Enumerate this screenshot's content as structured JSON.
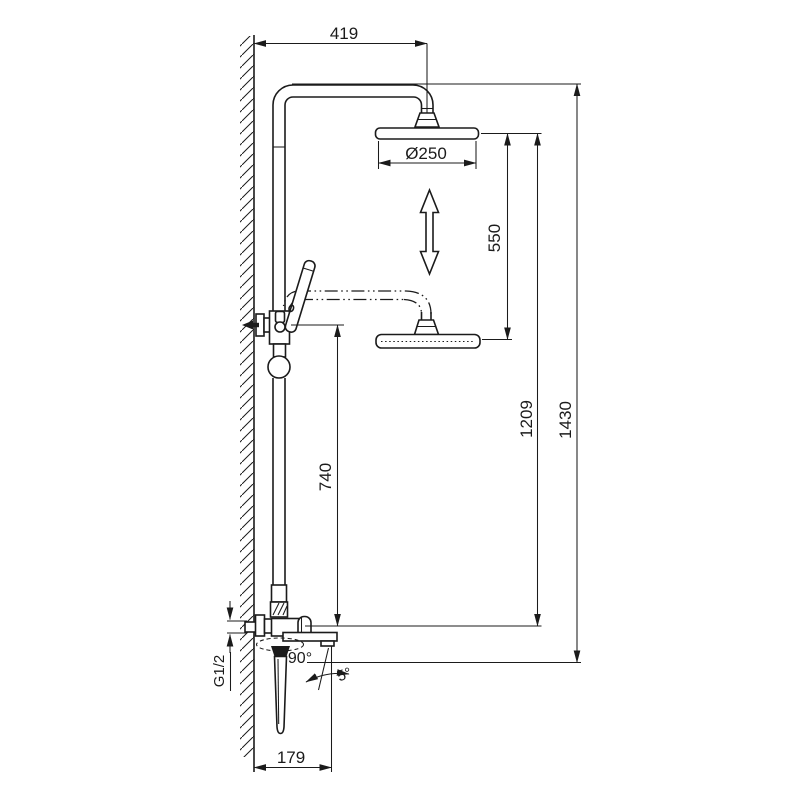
{
  "drawing": {
    "background_color": "#ffffff",
    "line_color": "#1b1b1b",
    "dimensions": {
      "arm_projection": "419",
      "head_diameter": "Ø250",
      "height_adjustment": "550",
      "hand_shower_height": "740",
      "head_height": "1209",
      "overall_height": "1430",
      "spout_projection": "179",
      "inlet_thread": "G1/2",
      "spout_swivel_angle": "90°",
      "spout_tilt_angle": "5°"
    }
  }
}
